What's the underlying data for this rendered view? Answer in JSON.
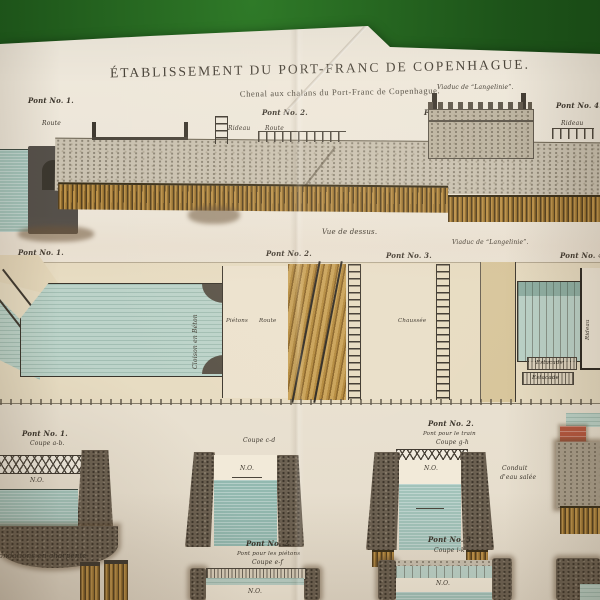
{
  "palette": {
    "felt_green": "#1d5319",
    "paper": "#ece5d8",
    "ink": "#3e382f",
    "water_teal": "#a2c3ba",
    "plan_water_teal": "#bcd3c9",
    "timber_gold": "#bb9149",
    "masonry_grey": "#c9c1b0",
    "dark_wall": "#6b6051",
    "brick_red": "#b5573f",
    "bank_tan": "#e7dcc2",
    "khaki": "#d8c69c"
  },
  "header": {
    "title": "ÉTABLISSEMENT DU PORT-FRANC DE COPENHAGUE.",
    "subtitle": "Chenal aux chalans du Port-Franc de Copenhague.",
    "viaduct_note": "Viaduc de “Langelinie”."
  },
  "elevation": {
    "pont1": "Pont No. 1.",
    "route_left": "Route",
    "pont2": "Pont No. 2.",
    "rideau_2": "Rideau",
    "route_2": "Route",
    "pont3": "Pont No. 3.",
    "rideau_3": "Rideau",
    "pont4": "Pont No. 4.",
    "rideau_4": "Rideau"
  },
  "plan": {
    "view_label": "Vue de dessus.",
    "pont1": "Pont No. 1.",
    "pont2": "Pont No. 2.",
    "pont3": "Pont No. 3.",
    "viaduct": "Viaduc de “Langelinie”.",
    "pont4": "Pont No. 4.",
    "channel_label": "Cloison en Béton",
    "pietons": "Piétons",
    "route": "Route",
    "chaussee": "Chaussée",
    "estacade_1": "Estacade",
    "estacade_2": "Estacade",
    "rideau": "Rideau"
  },
  "sections": {
    "level_mark": "N.O.",
    "s1": {
      "title": "Pont No. 1.",
      "cut": "Coupe a-b."
    },
    "s2": {
      "cut": "Coupe c-d"
    },
    "s3": {
      "title": "Pont No. 2.",
      "note": "Pont pour le train",
      "cut": "Coupe g-h"
    },
    "conduit": {
      "line1": "Conduit",
      "line2": "d'eau salée"
    },
    "foundations_note": "Fondations en charpente",
    "s4": {
      "title": "Pont No. 2.",
      "note": "Pont pour les piétons",
      "cut": "Coupe e-f"
    },
    "s5": {
      "title": "Pont No. 3.",
      "cut": "Coupe i-k"
    }
  }
}
